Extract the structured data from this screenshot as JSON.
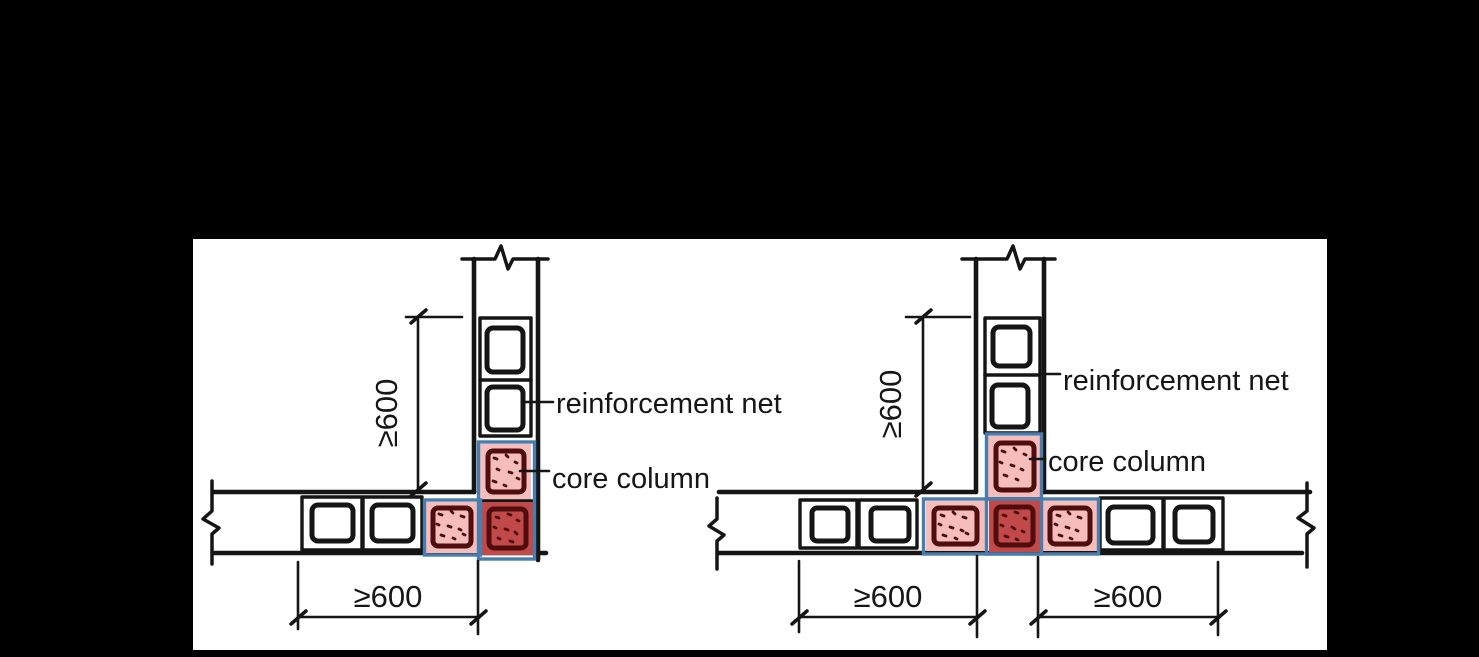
{
  "colors": {
    "background": "#000000",
    "panel": "#ffffff",
    "ink": "#151515",
    "cell_pink": "#f6bdbd",
    "cell_red": "#c24949",
    "cell_red_inner": "#eca6a6",
    "cell_maroon": "#4f0d0d",
    "grout_outline_blue": "#4a7dab"
  },
  "left_diagram": {
    "reinforcement_net_label": "reinforcement net",
    "core_column_label": "core column",
    "vertical_dim": "≥600",
    "bottom_dim": "≥600"
  },
  "right_diagram": {
    "reinforcement_net_label": "reinforcement net",
    "core_column_label": "core column",
    "vertical_dim": "≥600",
    "bottom_left_dim": "≥600",
    "bottom_right_dim": "≥600"
  }
}
